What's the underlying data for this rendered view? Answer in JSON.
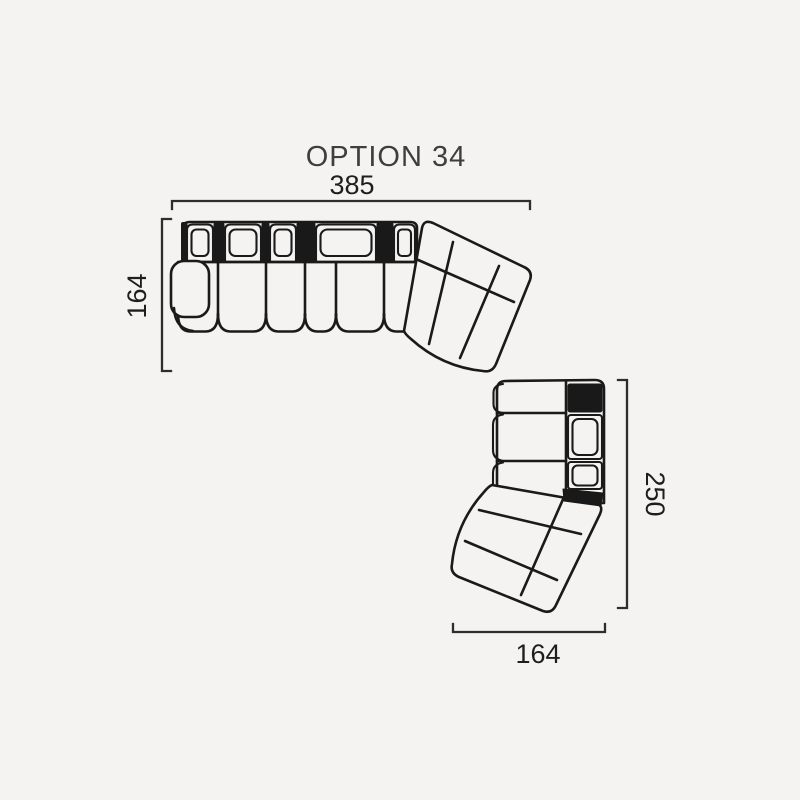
{
  "title": "OPTION 34",
  "dims": {
    "top": "385",
    "left": "164",
    "right": "250",
    "bottom": "164"
  },
  "diagram": {
    "type": "sofa-sectional-plan",
    "pieces": [
      "straight-sofa-with-left-armrest-6-modules",
      "corner-wedge-upper",
      "straight-sofa-right-2-modules",
      "corner-wedge-lower"
    ]
  },
  "colors": {
    "background": "#f4f3f1",
    "line": "#1a1a1a",
    "dark_panel": "#191919",
    "dimension_line": "#2d2d2d",
    "dimension_text": "#1e1e1e",
    "title_text": "#3e3e3e"
  }
}
